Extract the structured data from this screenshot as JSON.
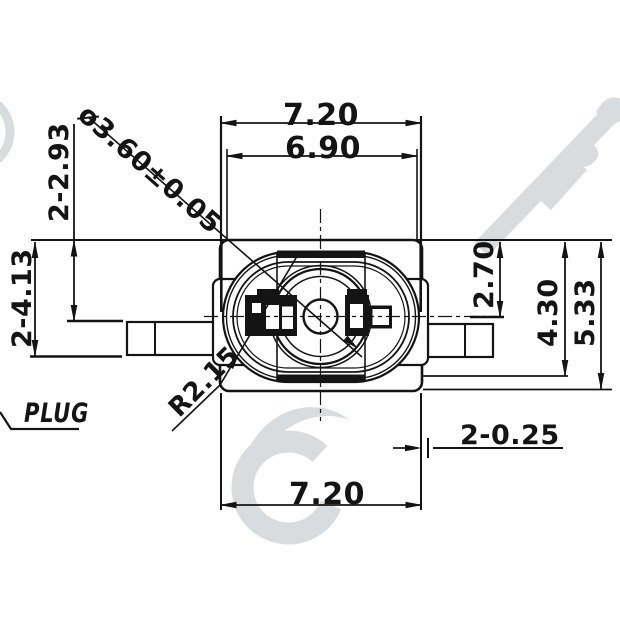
{
  "drawing": {
    "title_label": "PLUG",
    "dimensions": {
      "top_width_outer": "7.20",
      "top_width_inner": "6.90",
      "bottom_width": "7.20",
      "diameter_with_tolerance": "ø3.60±0.05",
      "left_upper_height": "2-2.93",
      "left_lower_height": "2-4.13",
      "corner_radius": "R2.15",
      "right_height_to_center": "2.70",
      "right_height_mid": "4.30",
      "right_height_full": "5.33",
      "edge_step": "2-0.25"
    },
    "colors": {
      "line": "#141414",
      "watermark": "#d9dcde",
      "background": "#ffffff"
    }
  }
}
